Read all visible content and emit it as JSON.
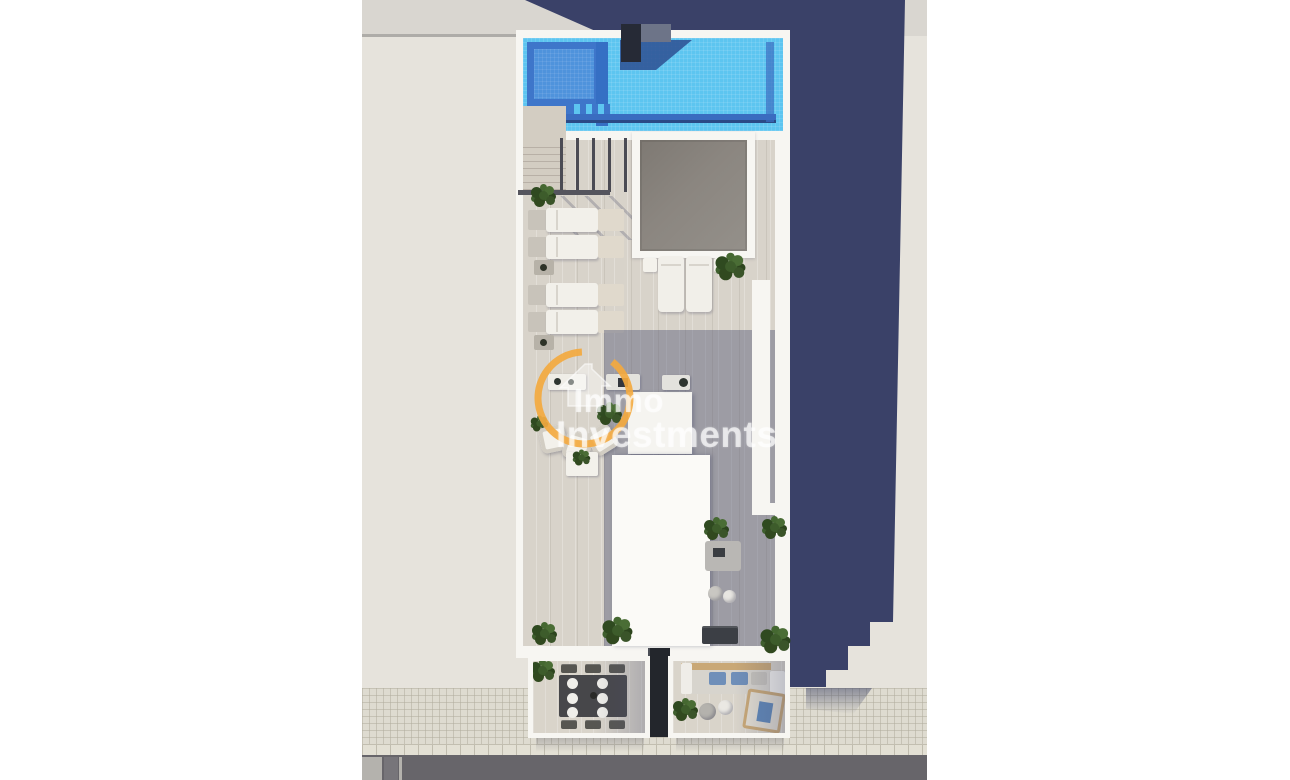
{
  "watermark": {
    "line1": "Immo",
    "line2": "Investments",
    "logo_icon": "house-in-ring-icon",
    "ring_color": "#f3a93f",
    "text_color": "rgba(255,255,255,0.66)"
  },
  "palette": {
    "neighbor_beige": "#e6e3dc",
    "neighbor_beige_top": "#d9d6d0",
    "shadow_navy": "#3a4168",
    "building_white": "#f7f6f2",
    "pool_blue": "#5dc5f0",
    "pool_shadow_blue": "#3e76ca",
    "pool_deep_blue": "#3a6cc0",
    "pool_inner_blue": "#4f93dc",
    "chimney_dark": "#262a36",
    "deck_light": "#d8d3ca",
    "deck_shadow_overlay": "rgba(76,81,112,0.42)",
    "skylight_gray": "#8b8680",
    "plant_green": "#3d5c2b",
    "sidewalk_gray": "#dedbd0",
    "road_gray": "#67656a",
    "terrace_table_dark": "#47474a",
    "cushion_blue": "#6f8fb9",
    "wood_tan": "#c9a876"
  },
  "scene": {
    "type": "aerial-3d-render",
    "subject": "rooftop solarium of a residential building with swimming pool, sun deck, skylight and two street-side terraces",
    "features": [
      "swimming-pool",
      "pool-steps",
      "chimney",
      "staircase-with-railing",
      "skylight",
      "sun-loungers",
      "side-tables",
      "planter-bushes",
      "outdoor-counter",
      "armchair-seating",
      "stairwell-roof-volume",
      "daybed-and-poufs",
      "dining-terrace",
      "lounge-terrace",
      "tiled-sidewalk",
      "asphalt-road",
      "building-cast-shadow"
    ]
  }
}
